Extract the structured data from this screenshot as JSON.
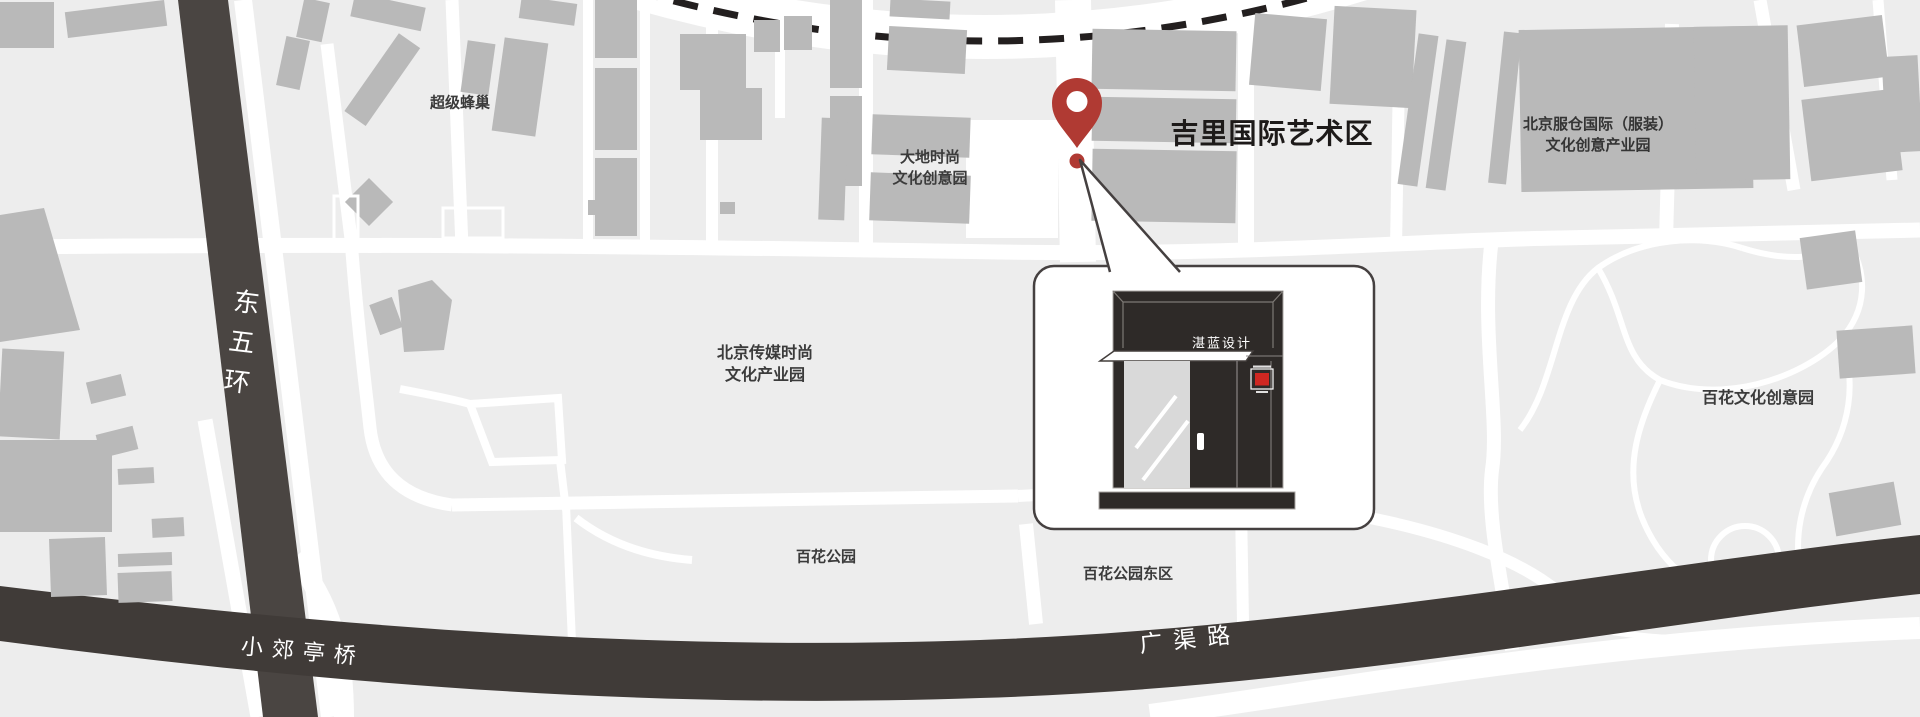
{
  "map": {
    "region_labels": {
      "super_hive": "超级蜂巢",
      "dadi": {
        "line1": "大地时尚",
        "line2": "文化创意园"
      },
      "jili_title": "吉里国际艺术区",
      "fucang": {
        "line1": "北京服仓国际（服装）",
        "line2": "文化创意产业园"
      },
      "chuanmei": {
        "line1": "北京传媒时尚",
        "line2": "文化产业园"
      },
      "baihua_creative_park": "百花文化创意园",
      "baihua_park": "百花公园",
      "baihua_park_east": "百花公园东区"
    },
    "road_labels": {
      "east_fifth_ring": "东五环",
      "xiaojiaoting_bridge": "小郊亭桥",
      "guangqu_road": "广渠路"
    },
    "callout": {
      "sign_text": "湛蓝设计"
    },
    "colors": {
      "background": "#ededed",
      "road_white": "#ffffff",
      "building_gray": "#b9b9b9",
      "dark_road": "#4a4542",
      "dark_road_bottom": "#403b38",
      "dashed_line": "#231f1f",
      "pin_red": "#b03a33",
      "storefront_dark": "#2e2a28",
      "logo_red": "#cf2721"
    }
  }
}
